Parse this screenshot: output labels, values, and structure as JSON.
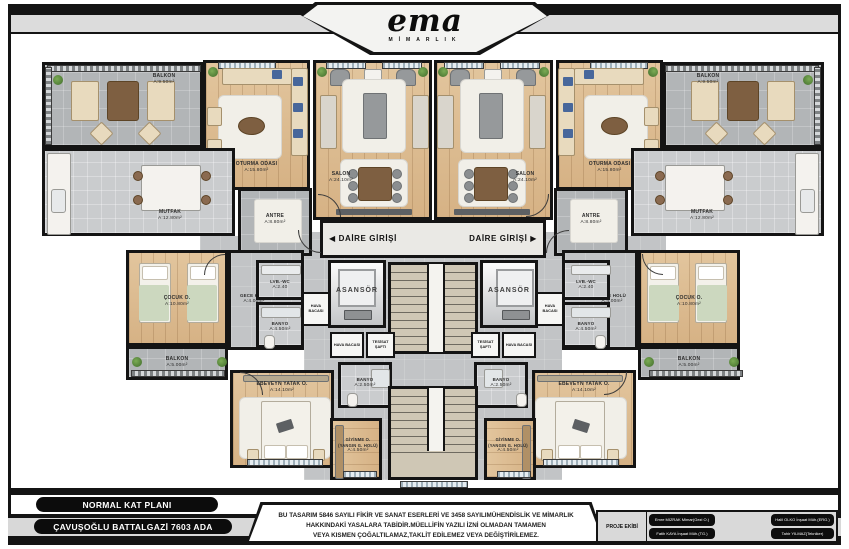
{
  "header": {
    "logo": "ema",
    "logo_subtitle": "MİMARLIK"
  },
  "rooms": {
    "balkon_buyuk": {
      "name": "BALKON",
      "area": "A:9.50m²"
    },
    "oturma_odasi": {
      "name": "OTURMA ODASI",
      "area": "A:15.80m²"
    },
    "salon": {
      "name": "SALON",
      "area": "A:24.10m²"
    },
    "mutfak": {
      "name": "MUTFAK",
      "area": "A:12.80m²"
    },
    "antre": {
      "name": "ANTRE",
      "area": "A:8.80m²"
    },
    "cocuk_odasi": {
      "name": "ÇOCUK O.",
      "area": "A:10.80m²"
    },
    "gece_holu": {
      "name": "GECE HOLÜ",
      "area": "A:4.00m²"
    },
    "lavabo_wc": {
      "name": "LVB.-WC",
      "area": "A:2.40"
    },
    "banyo": {
      "name": "BANYO",
      "area": "A:4.50m²"
    },
    "balkon_kucuk": {
      "name": "BALKON",
      "area": "A:5.00m²"
    },
    "ebeveyn_yatak": {
      "name": "EBEVEYN YATAK O.",
      "area": "A:14.10m²"
    },
    "banyo_kucuk": {
      "name": "BANYO",
      "area": "A:2.50m²"
    },
    "giyinme": {
      "name": "GİYİNME O.",
      "subname": "(YANGIN G. HOLÜ)",
      "area": "A:4.50m²"
    },
    "asansor": {
      "name": "ASANSÖR"
    },
    "hava_bacasi": {
      "name": "HAVA BACASI"
    },
    "tesisat_safti": {
      "name": "TESİSAT ŞAFTI"
    },
    "daire_girisi": {
      "name": "DAİRE GİRİŞİ",
      "arrow_left": "◀",
      "arrow_right": "▶"
    }
  },
  "footer": {
    "plan_label": "NORMAL KAT PLANI",
    "project_label": "ÇAVUŞOĞLU BATTALGAZİ 7603 ADA",
    "copyright": {
      "line1": "BU TASARIM 5846 SAYILI FİKİR VE SANAT ESERLERİ VE 3458 SAYILIMÜHENDİSLİK VE MİMARLIK",
      "line2": "HAKKINDAKİ YASALARA TABİDİR.MÜELLİFİN YAZILI İZNİ OLMADAN TAMAMEN",
      "line3": "VEYA KISMEN ÇOĞALTILAMAZ,TAKLİT EDİLEMEZ VEYA DEĞİŞTİRİLEMEZ."
    },
    "team": {
      "header": "PROJE EKİBİ",
      "members": [
        "Emre MIZRAK Mimar(Gezi O.)",
        "Fatih KAYA İnşaat Müh.(TG.)",
        "Halil OLKO İnşaat Müh.(ERG.)",
        "Tahir YILMAZ(Tekniker)"
      ]
    }
  },
  "colors": {
    "wall": "#141414",
    "wood_floor": "#ddbd92",
    "tile_floor": "#b2b5b7",
    "cushion_blue": "#48679b",
    "plant_green": "#4f7d3a"
  }
}
